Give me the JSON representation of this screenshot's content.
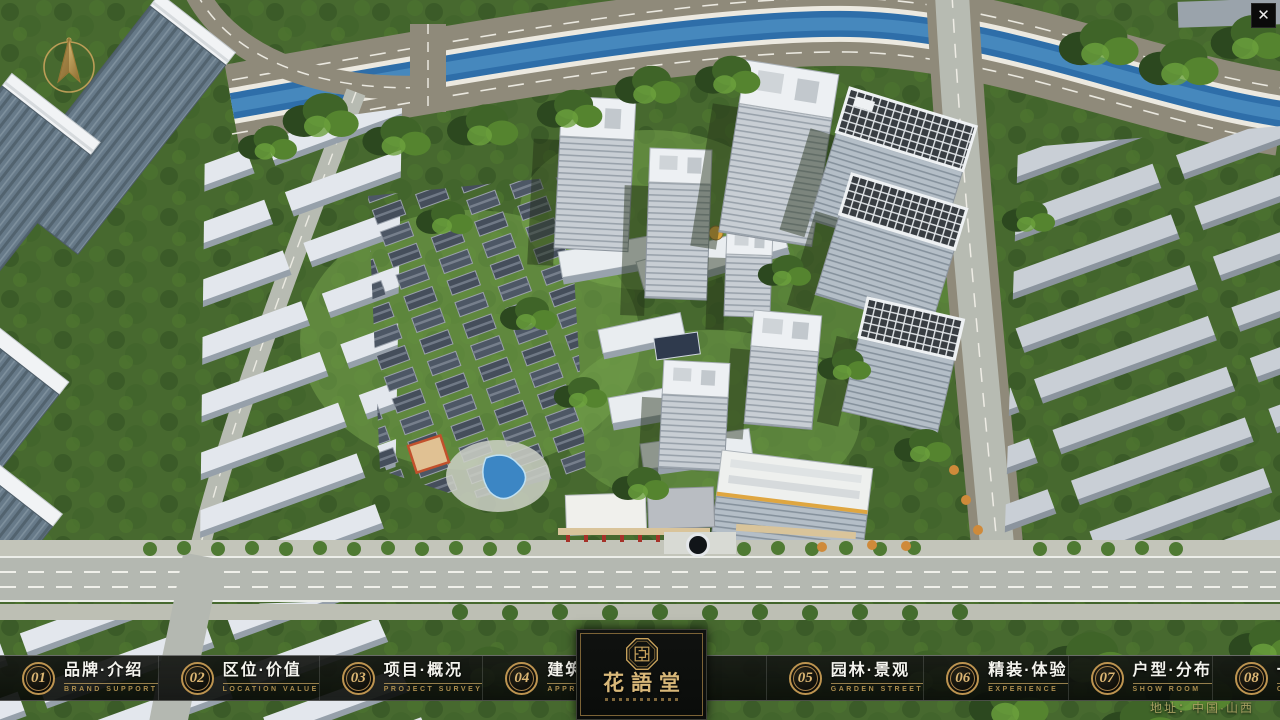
{
  "window": {
    "close_icon": "✕"
  },
  "branding": {
    "logo_name": "花語堂",
    "emblem": "octagonal-seal"
  },
  "nav": {
    "items": [
      {
        "number": "01",
        "label": "品牌·介绍",
        "sublabel": "BRAND SUPPORT"
      },
      {
        "number": "02",
        "label": "区位·价值",
        "sublabel": "LOCATION VALUE"
      },
      {
        "number": "03",
        "label": "项目·概况",
        "sublabel": "PROJECT SURVEY"
      },
      {
        "number": "04",
        "label": "建筑·鉴赏",
        "sublabel": "APPRECIATION"
      },
      {
        "number": "05",
        "label": "园林·景观",
        "sublabel": "GARDEN STREET"
      },
      {
        "number": "06",
        "label": "精装·体验",
        "sublabel": "EXPERIENCE"
      },
      {
        "number": "07",
        "label": "户型·分布",
        "sublabel": "SHOW ROOM"
      },
      {
        "number": "08",
        "label": "一房·一景",
        "sublabel": "COMMUNITY"
      }
    ]
  },
  "footer": {
    "address": "地址：中国·山西"
  },
  "colors": {
    "gold": "#c9a35c",
    "nav_background": "#0d0f0c",
    "river_blue": "#2e6ea9",
    "road_tan": "#8f8a7a",
    "tree_green": "#3d6128",
    "accent_red": "#a63229",
    "accent_orange": "#e0a43e"
  }
}
